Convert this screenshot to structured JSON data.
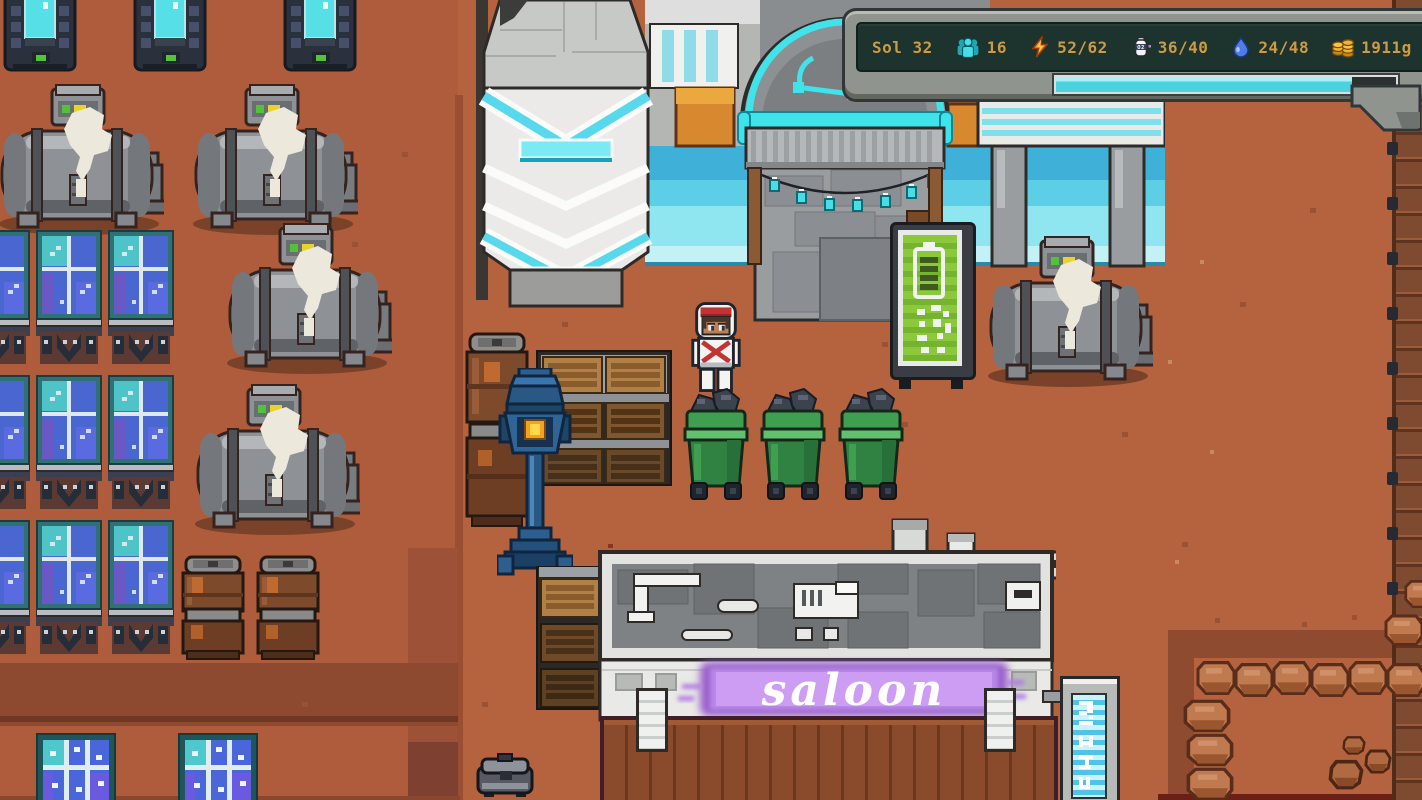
{
  "hud": {
    "sol": "Sol 32",
    "colonists": "16",
    "power": "52/62",
    "oxygen": "36/40",
    "oxygen_icon_label": "O2",
    "water": "24/48",
    "credits": "1911g",
    "progress_percent": 87,
    "progress_fill_style": "width:87%",
    "colors": {
      "text": "#cf9a42",
      "panel": "#1d332e",
      "frame": "#90948e",
      "bar_fill": "#4cd2de"
    }
  },
  "scene": {
    "saloon_sign": "saloon",
    "colors": {
      "ground": "#b5633f",
      "neon_purple": "#b06fe0",
      "accent_cyan": "#3fe4ea",
      "bin_green": "#3f9e50",
      "battery_green": "#8cc83c",
      "solar_blue": "#4a66d4"
    }
  }
}
